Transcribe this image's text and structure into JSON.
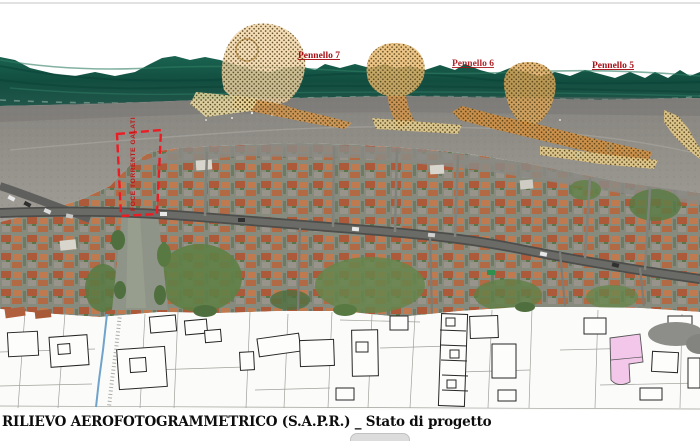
{
  "document": {
    "caption": "RILIEVO AEROFOTOGRAMMETRICO (S.A.P.R.) _ Stato di progetto"
  },
  "map": {
    "labels": {
      "pennello_7": "Pennello 7",
      "pennello_6": "Pennello 6",
      "pennello_5": "Pennello 5",
      "river_mouth": "FOCE TORRENTE GALATI"
    },
    "colors": {
      "sea_green": "#14584a",
      "beach_gray": "#918f8a",
      "nourishment_light": "#f4d7a8",
      "nourishment_orange": "#dc9a4e",
      "nourishment_pale": "#eed28e",
      "label_red": "#a61016",
      "boundary_red": "#ec1c24",
      "cadastral_pink": "#f2c7ea",
      "stream_blue": "#6fa3cc"
    }
  }
}
